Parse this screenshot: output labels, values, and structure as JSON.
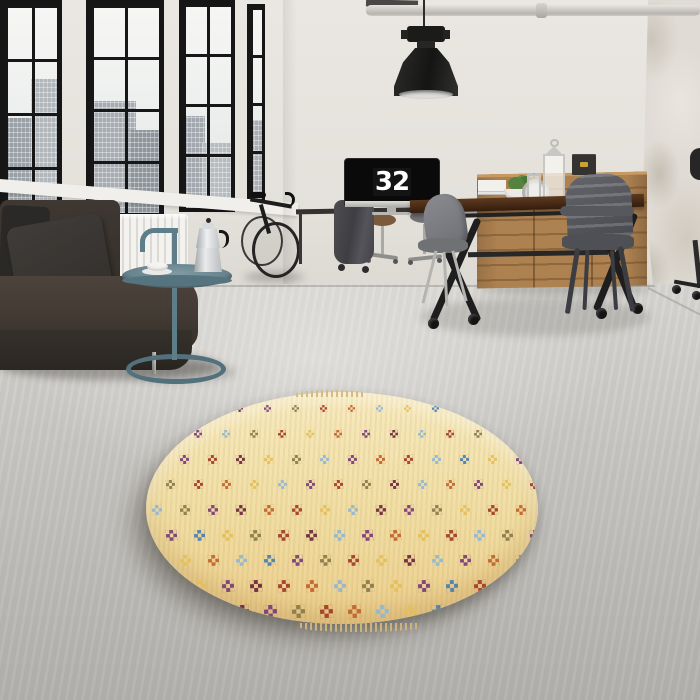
{
  "scene": {
    "description": "Industrial loft interior: black-framed factory windows over a city view, dark leather sofa with cushions, teal tubular side table with a moka pot and cup, bicycle against the wall, desk with a monitor showing the time, wooden dining table with metal chairs, oak credenza with storage boxes, lanterns and a plant, industrial pendant lamp, and a round cream kilim rug with checkered motifs on a concrete floor",
    "objects": [
      "windows",
      "city-view",
      "radiator",
      "sofa",
      "pillows",
      "side-table",
      "moka-pot",
      "coffee-cup",
      "bicycle",
      "desk",
      "monitor-clock",
      "office-chairs",
      "coat",
      "dining-table",
      "metal-chairs",
      "credenza",
      "storage-boxes",
      "plant",
      "lanterns",
      "gauge-clock",
      "pendant-lamp",
      "ceiling-pipe",
      "round-rug",
      "concrete-floor"
    ]
  },
  "clock": {
    "hours": "11",
    "minutes": "32"
  },
  "palette": {
    "wall": "#eae7e2",
    "floor_near": "#d8d6d2",
    "floor_far": "#b2b0ac",
    "window_frame": "#161616",
    "sofa": "#3b342e",
    "radiator": "#f3f2ee",
    "side_table": "#5d7d89",
    "rug_base": "#f0dda2",
    "table_wood": "#452815",
    "credenza_wood": "#ad8150",
    "box": "#343330",
    "box_clasp": "#c9a23a",
    "lamp": "#1b1b1a"
  },
  "rug": {
    "background_top": "#f7eabf",
    "background_bottom": "#eccf8e",
    "motif_colors": [
      "#a43f2a",
      "#7c4079",
      "#93b7d1",
      "#e6bf5b",
      "#8c7c4c",
      "#c2662f",
      "#6f2b3f",
      "#4f7fae"
    ],
    "motif_sequence": [
      0,
      3,
      2,
      6,
      1,
      4,
      0,
      5,
      2,
      3,
      7,
      1,
      5,
      0,
      6,
      3,
      1,
      2,
      4,
      0,
      3,
      5,
      1,
      6,
      2,
      0,
      4,
      3,
      7,
      2,
      5,
      1,
      0,
      6,
      3,
      4,
      2,
      1,
      5,
      0,
      2,
      7,
      3,
      1,
      6,
      4,
      0,
      5,
      3,
      2,
      1,
      0,
      4,
      6,
      2,
      5,
      1,
      3,
      0,
      7,
      2,
      4,
      1,
      6,
      5,
      0,
      3,
      2,
      6,
      1,
      4,
      3,
      0,
      5,
      2,
      1,
      7,
      3,
      4,
      0,
      6,
      2,
      1,
      5,
      3,
      0,
      2,
      4,
      1,
      6,
      0,
      3,
      5,
      2,
      7,
      1,
      4,
      0,
      3,
      6,
      2,
      1,
      5,
      4,
      0,
      2,
      3,
      1,
      6,
      0,
      5,
      2,
      4,
      3,
      1,
      7,
      0,
      6,
      2,
      5
    ],
    "grid": {
      "rows": 9,
      "cols": 15,
      "spacing_x": 28,
      "spacing_y": 25,
      "motif_size": 10,
      "row_offset": 14,
      "start_x": 6,
      "start_y": 13
    }
  }
}
